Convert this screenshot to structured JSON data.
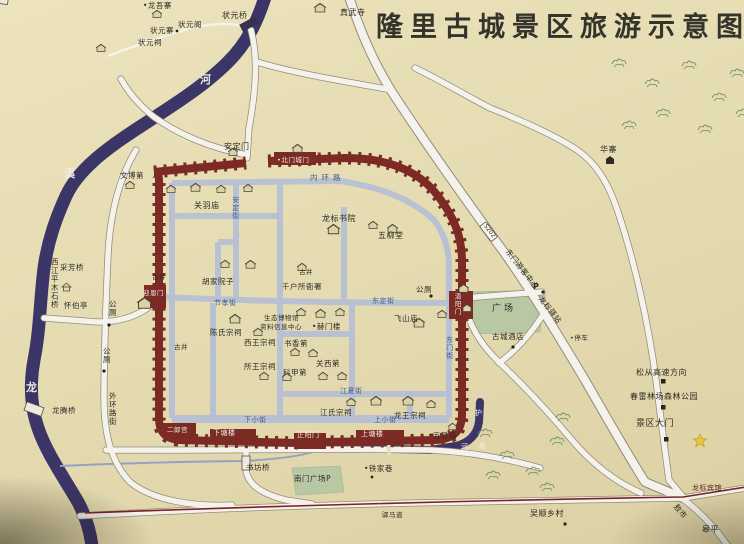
{
  "title": "隆里古城景区旅游示意图",
  "colors": {
    "paper": "#e6dcb2",
    "river": "#3c3668",
    "wall": "#7c2a24",
    "street": "#b6bfd4",
    "road_fill": "#f4f2ea",
    "road_edge": "#8f8c7c",
    "green": "#b9c8a4",
    "red_route": "#7a2420",
    "title": "#34342c",
    "label": "#2c2a25",
    "street_label": "#3f5f92",
    "white_label": "#f2efe6",
    "star": "#e6c933",
    "tree": "#5e8a5e"
  },
  "labels": [
    {
      "n": "village-longwuzhai",
      "t": "•龙吾寨",
      "x": 143,
      "y": 2,
      "fs": 7.5
    },
    {
      "n": "zhuangyuan-ge",
      "t": "状元阁",
      "x": 178,
      "y": 21,
      "fs": 7.5
    },
    {
      "n": "zhuangyuan-zhai",
      "t": "状元寨",
      "x": 150,
      "y": 27,
      "fs": 7.5
    },
    {
      "n": "zhuangyuan-ci",
      "t": "状元祠",
      "x": 138,
      "y": 39,
      "fs": 7.5
    },
    {
      "n": "zhuangyuan-qiao",
      "t": "状元桥",
      "x": 222,
      "y": 12
    },
    {
      "n": "zhenwu-si",
      "t": "真武寺",
      "x": 340,
      "y": 9
    },
    {
      "n": "huazhai",
      "t": "华寨",
      "x": 600,
      "y": 146
    },
    {
      "n": "he-char",
      "t": "河",
      "x": 200,
      "y": 74,
      "c": "rc"
    },
    {
      "n": "xi-char",
      "t": "溪",
      "x": 64,
      "y": 168,
      "c": "rc"
    },
    {
      "n": "long-char",
      "t": "龙",
      "x": 26,
      "y": 382,
      "c": "rc"
    },
    {
      "n": "xijiang-bridge-label",
      "t": "西江平木石桥",
      "x": 50,
      "y": 258,
      "v": 1,
      "fs": 7.5
    },
    {
      "n": "caifang-qiao",
      "t": "采芳桥",
      "x": 60,
      "y": 264,
      "fs": 7.5
    },
    {
      "n": "huaibo-ting",
      "t": "怀伯亭",
      "x": 64,
      "y": 302,
      "fs": 7.5
    },
    {
      "n": "toilet-label-1",
      "t": "公厕",
      "x": 108,
      "y": 300,
      "v": 1,
      "fs": 7.5
    },
    {
      "n": "toilet-label-2",
      "t": "公厕",
      "x": 102,
      "y": 347,
      "v": 1,
      "fs": 7.5
    },
    {
      "n": "wenbo-di",
      "t": "文博第",
      "x": 120,
      "y": 172,
      "fs": 7.5
    },
    {
      "n": "anding-men",
      "t": "安定门",
      "x": 224,
      "y": 143
    },
    {
      "n": "beimen-chengmen",
      "t": "•北门城门",
      "x": 277,
      "y": 157,
      "c": "w",
      "fs": 6.5
    },
    {
      "n": "neihuan-lu",
      "t": "内环路",
      "x": 310,
      "y": 174,
      "c": "s",
      "fs": 7.5,
      "ls": 4
    },
    {
      "n": "guanyu-miao",
      "t": "关羽庙",
      "x": 194,
      "y": 202
    },
    {
      "n": "longbiao-shuyuan",
      "t": "龙标书院",
      "x": 322,
      "y": 215
    },
    {
      "n": "wuliu-tang",
      "t": "五柳堂",
      "x": 378,
      "y": 232
    },
    {
      "n": "anding-jie",
      "t": "安定街",
      "x": 231,
      "y": 196,
      "c": "s",
      "v": 1,
      "fs": 7
    },
    {
      "n": "hujia-yuanzi",
      "t": "胡家院子",
      "x": 202,
      "y": 278,
      "fs": 7.5
    },
    {
      "n": "qianhusuo-yashu",
      "t": "千户所衙署",
      "x": 282,
      "y": 283,
      "fs": 7.5
    },
    {
      "n": "toilet-label-3",
      "t": "公厕",
      "x": 416,
      "y": 286,
      "fs": 7.5
    },
    {
      "n": "yingen-men",
      "t": "迎恩门",
      "x": 143,
      "y": 290,
      "c": "w",
      "fs": 6.5
    },
    {
      "n": "jiexiao-jie",
      "t": "节孝街",
      "x": 214,
      "y": 300,
      "c": "s",
      "fs": 7
    },
    {
      "n": "dongding-jie",
      "t": "东定街",
      "x": 372,
      "y": 298,
      "c": "s",
      "fs": 7
    },
    {
      "n": "qingyang-men",
      "t": "清阳门",
      "x": 453,
      "y": 293,
      "c": "w",
      "v": 1,
      "fs": 6.5
    },
    {
      "n": "chenshi-zongci",
      "t": "陈氏宗祠",
      "x": 210,
      "y": 329,
      "fs": 7.5
    },
    {
      "n": "museum-line1",
      "t": "生态博物馆",
      "x": 264,
      "y": 315,
      "fs": 6.5
    },
    {
      "n": "museum-line2",
      "t": "资料信息中心",
      "x": 260,
      "y": 324,
      "fs": 6.5
    },
    {
      "n": "hemen-lou",
      "t": "•赫门楼",
      "x": 312,
      "y": 323,
      "fs": 7.5
    },
    {
      "n": "feishan-miao",
      "t": "飞山庙",
      "x": 394,
      "y": 315,
      "fs": 7.5
    },
    {
      "n": "xiwang-zongci",
      "t": "西王宗祠",
      "x": 244,
      "y": 339,
      "fs": 7.5
    },
    {
      "n": "shuxiang-di",
      "t": "书香第",
      "x": 284,
      "y": 340,
      "fs": 7.5
    },
    {
      "n": "suowang-zongci",
      "t": "所王宗祠",
      "x": 244,
      "y": 363,
      "fs": 7.5
    },
    {
      "n": "kejia-di",
      "t": "科甲第",
      "x": 283,
      "y": 369,
      "fs": 7.5
    },
    {
      "n": "guanxi-di",
      "t": "关西第",
      "x": 316,
      "y": 360,
      "fs": 7.5
    },
    {
      "n": "dongmen-jie",
      "t": "东门街",
      "x": 445,
      "y": 336,
      "c": "s",
      "v": 1,
      "fs": 7
    },
    {
      "n": "gujing-1",
      "t": "古井",
      "x": 152,
      "y": 274,
      "c": "t"
    },
    {
      "n": "gujing-2",
      "t": "古井",
      "x": 174,
      "y": 344,
      "c": "t"
    },
    {
      "n": "gujing-3",
      "t": "古井",
      "x": 299,
      "y": 269,
      "c": "t"
    },
    {
      "n": "guangchang",
      "t": "广场",
      "x": 492,
      "y": 305,
      "fs": 9,
      "ls": 3
    },
    {
      "n": "gucheng-jiudian",
      "t": "古城酒店",
      "x": 492,
      "y": 333,
      "fs": 7.5
    },
    {
      "n": "dongmen-visitor-center",
      "t": "东门游客中心",
      "x": 510,
      "y": 248,
      "r": 52,
      "fs": 7.5
    },
    {
      "n": "parking-P",
      "t": "P",
      "x": 533,
      "y": 283,
      "fs": 8,
      "b": 1
    },
    {
      "n": "longbiao-yizhan",
      "t": "龙标驿站",
      "x": 543,
      "y": 295,
      "r": 52,
      "fs": 7.5
    },
    {
      "n": "tingche",
      "t": "•停车",
      "x": 570,
      "y": 335,
      "c": "t"
    },
    {
      "n": "s202-badge",
      "t": "S202",
      "x": 486,
      "y": 221,
      "c": "badge",
      "r": 52
    },
    {
      "n": "songcong-expressway",
      "t": "松从高速方向",
      "x": 636,
      "y": 369
    },
    {
      "n": "chunlei-forest-park",
      "t": "春雷林场森林公园",
      "x": 630,
      "y": 393
    },
    {
      "n": "jingqu-damen",
      "t": "景区大门",
      "x": 636,
      "y": 420,
      "fs": 9
    },
    {
      "n": "longbiao-binguan",
      "t": "龙标宾馆",
      "x": 692,
      "y": 485,
      "fs": 7,
      "c": "dr"
    },
    {
      "n": "wushun-village",
      "t": "吴顺乡村",
      "x": 530,
      "y": 510
    },
    {
      "n": "aoshi",
      "t": "敖市",
      "x": 678,
      "y": 503,
      "r": 50,
      "fs": 7.5
    },
    {
      "n": "gaoping",
      "t": "皋平",
      "x": 702,
      "y": 526
    },
    {
      "n": "yima-dao",
      "t": "驿马道",
      "x": 382,
      "y": 512,
      "c": "t"
    },
    {
      "n": "erlang-gong",
      "t": "二郎宫",
      "x": 167,
      "y": 427,
      "c": "w",
      "fs": 6.5
    },
    {
      "n": "xiatang-lou",
      "t": "下塘楼",
      "x": 213,
      "y": 430,
      "c": "w",
      "fs": 7
    },
    {
      "n": "zhengyang-men",
      "t": "正阳门",
      "x": 297,
      "y": 432,
      "c": "w",
      "fs": 7
    },
    {
      "n": "shangtang-lou",
      "t": "上塘楼",
      "x": 361,
      "y": 431,
      "c": "w",
      "fs": 7
    },
    {
      "n": "wuxian-miao",
      "t": "•五显庙",
      "x": 428,
      "y": 432,
      "fs": 7.5
    },
    {
      "n": "jiangshi-zongci",
      "t": "江氏宗祠",
      "x": 320,
      "y": 409,
      "fs": 7.5
    },
    {
      "n": "longwang-zongci",
      "t": "龙王宗祠",
      "x": 394,
      "y": 412,
      "fs": 7.5
    },
    {
      "n": "xiaxiao-jie",
      "t": "下小街",
      "x": 244,
      "y": 417,
      "c": "s",
      "fs": 7
    },
    {
      "n": "shangxiao-jie",
      "t": "上小街",
      "x": 374,
      "y": 417,
      "c": "s",
      "fs": 7
    },
    {
      "n": "jiangxia-jie",
      "t": "江夏街",
      "x": 340,
      "y": 388,
      "c": "s",
      "fs": 7
    },
    {
      "n": "shufang-qiao",
      "t": "书坊桥",
      "x": 246,
      "y": 464,
      "fs": 7.5
    },
    {
      "n": "nanmen-guangchang",
      "t": "南门广场P",
      "x": 294,
      "y": 475,
      "fs": 7.5
    },
    {
      "n": "tiejia-xiang",
      "t": "•铁家巷",
      "x": 364,
      "y": 465,
      "fs": 7.5
    },
    {
      "n": "waihuan-lu",
      "t": "外环路街",
      "x": 108,
      "y": 392,
      "v": 1,
      "fs": 7.5
    },
    {
      "n": "longteng-qiao",
      "t": "龙腾桥",
      "x": 52,
      "y": 407,
      "fs": 7.5
    },
    {
      "n": "hucheng-char-hu",
      "t": "护",
      "x": 475,
      "y": 410,
      "c": "w",
      "fs": 7
    },
    {
      "n": "hucheng-char-he",
      "t": "河",
      "x": 461,
      "y": 444,
      "c": "w",
      "fs": 7
    },
    {
      "n": "hucheng-char-di",
      "t": "堤",
      "x": 479,
      "y": 443,
      "c": "w",
      "fs": 7
    }
  ]
}
